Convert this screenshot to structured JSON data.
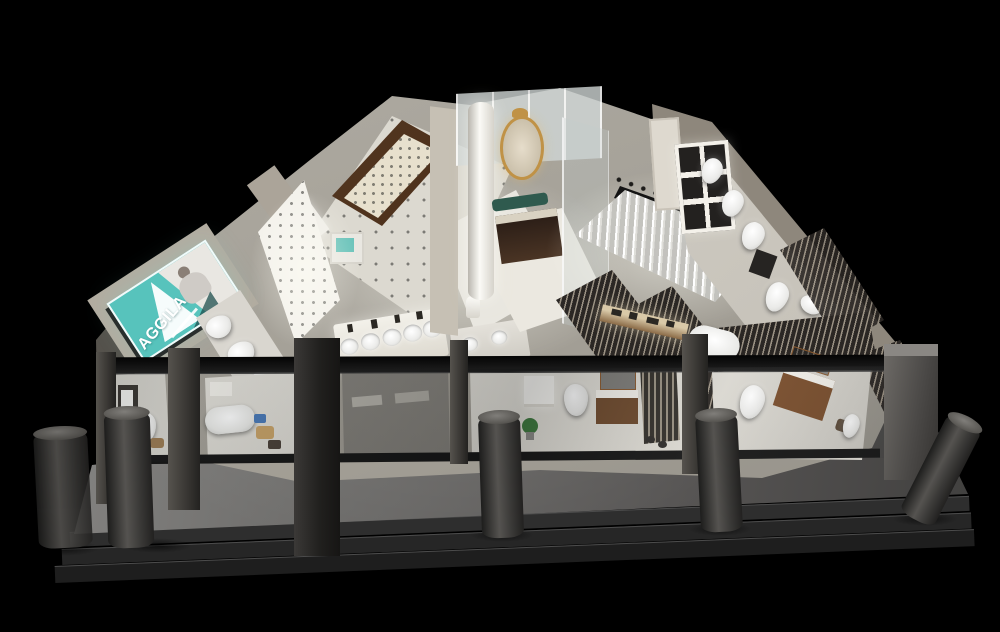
{
  "scene": {
    "description": "3D isometric night render of a bathroom and sanitaryware showroom, open-top dollhouse view with glass storefront, front pillars and steps",
    "background_color": "#000000"
  },
  "brand_sign": {
    "text": "AGGILA",
    "bg_color": "#57c3bc",
    "text_color": "#ffffff"
  },
  "palette": {
    "floor_light": "#e6e4dd",
    "wall_beige": "#b3aca0",
    "wood_brown": "#6f4b2e",
    "platform_gray": "#6f6e6c",
    "pillar_gray": "#3b3a38",
    "glass_frame_black": "#101010",
    "gold_mirror": "#c09246"
  }
}
